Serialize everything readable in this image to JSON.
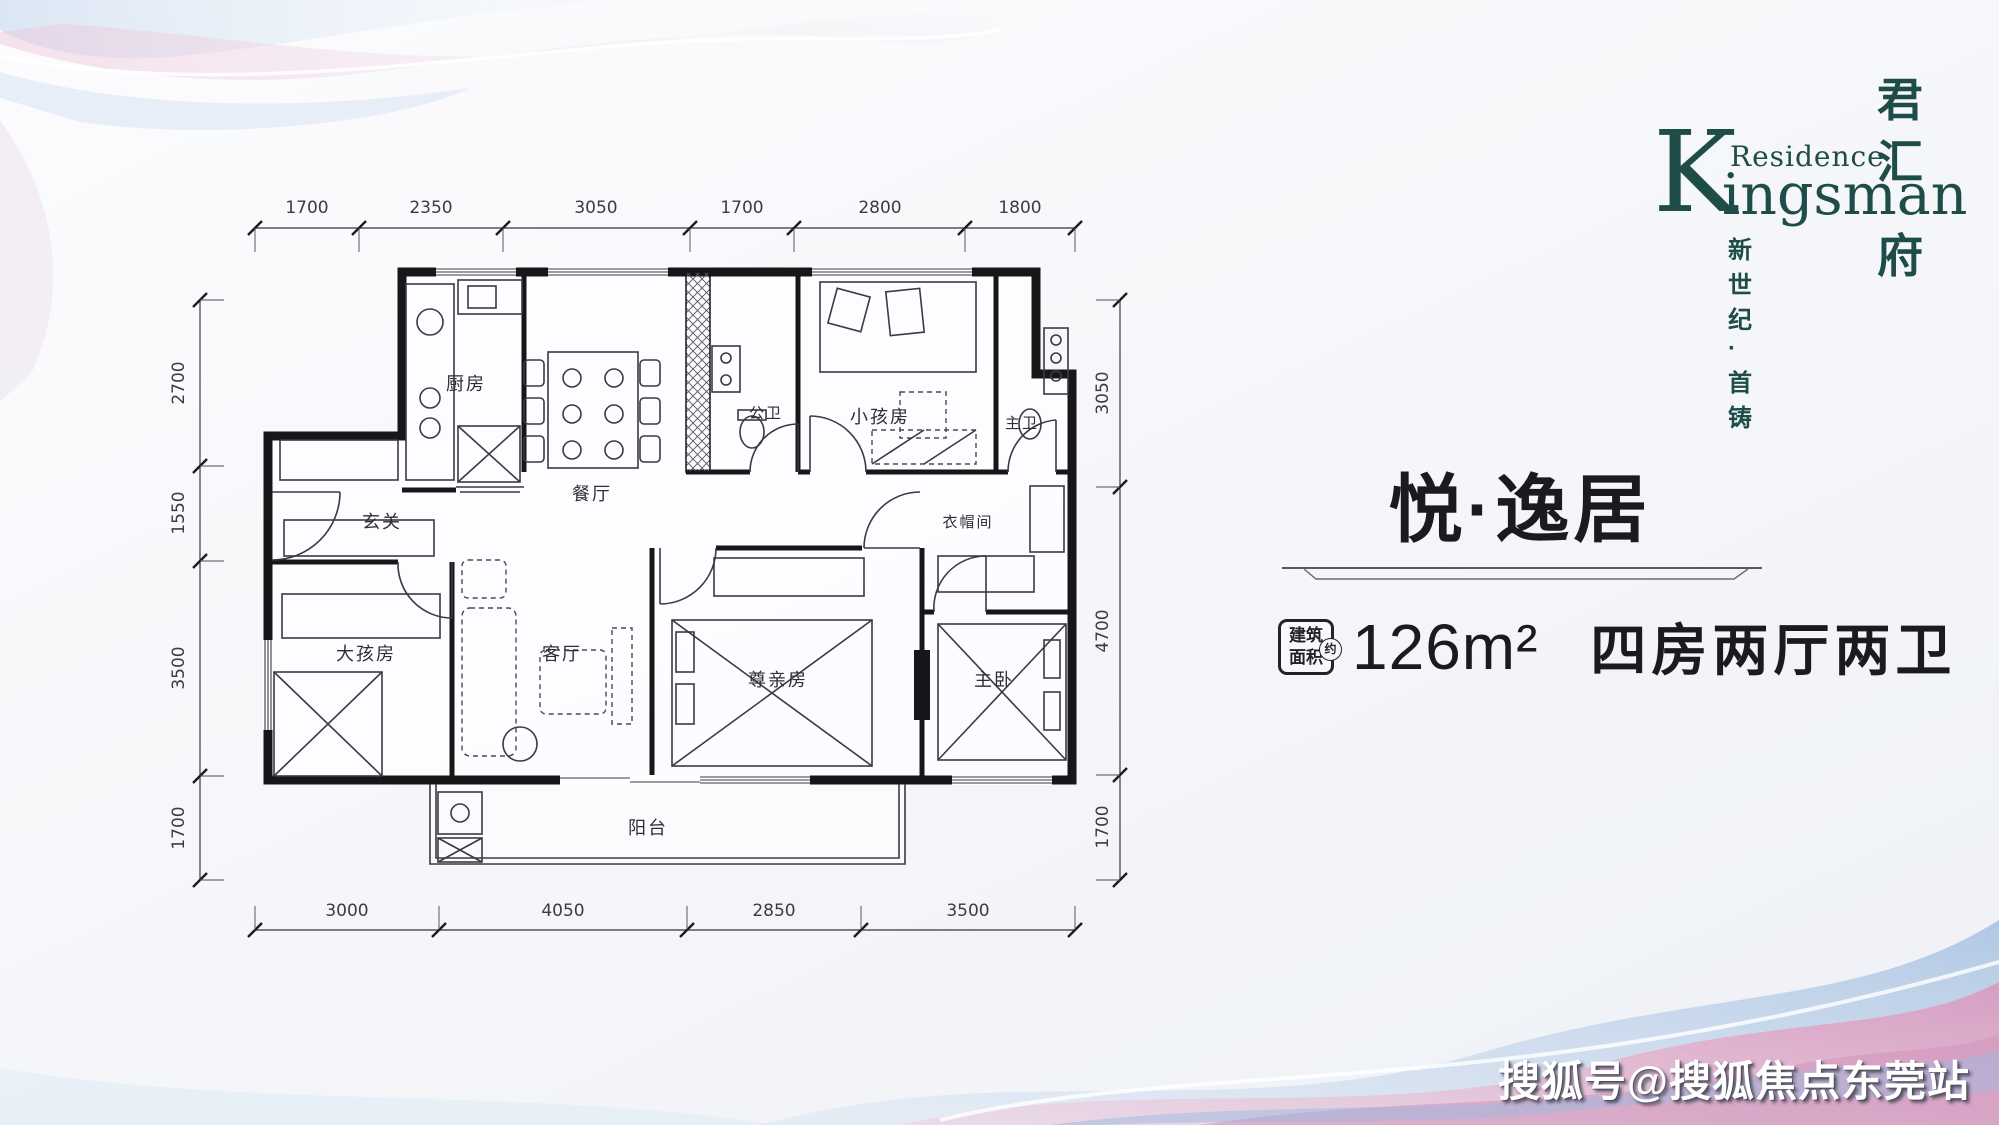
{
  "brand": {
    "k_initial": "K",
    "residence": "Residence",
    "ingsman": "ingsman",
    "vertical_name": [
      "君",
      "汇",
      "府"
    ],
    "tagline": "新世纪·首铸",
    "color": "#1e4d49"
  },
  "unit": {
    "title": "悦·逸居",
    "area_label_line1": "建筑",
    "area_label_line2": "面积",
    "approx": "约",
    "area_value": "126m²",
    "layout_text": "四房两厅两卫"
  },
  "floor_plan": {
    "rooms": {
      "kitchen": "厨房",
      "dining": "餐厅",
      "guest_bath": "公卫",
      "kids_room": "小孩房",
      "master_bath": "主卫",
      "foyer": "玄关",
      "cloakroom": "衣帽间",
      "big_kids_room": "大孩房",
      "living_room": "客厅",
      "parents_room": "尊亲房",
      "master_bedroom": "主卧",
      "balcony": "阳台"
    },
    "dims_top": [
      "1700",
      "2350",
      "3050",
      "1700",
      "2800",
      "1800"
    ],
    "dims_bottom": [
      "3000",
      "4050",
      "2850",
      "3500"
    ],
    "dims_left": [
      "2700",
      "1550",
      "3500",
      "1700"
    ],
    "dims_right": [
      "3050",
      "4700",
      "1700"
    ]
  },
  "watermark": "搜狐号@搜狐焦点东莞站",
  "colors": {
    "wave_pink": "#e9c3d7",
    "wave_blue": "#aec7e6",
    "plan_line": "#17171a"
  }
}
